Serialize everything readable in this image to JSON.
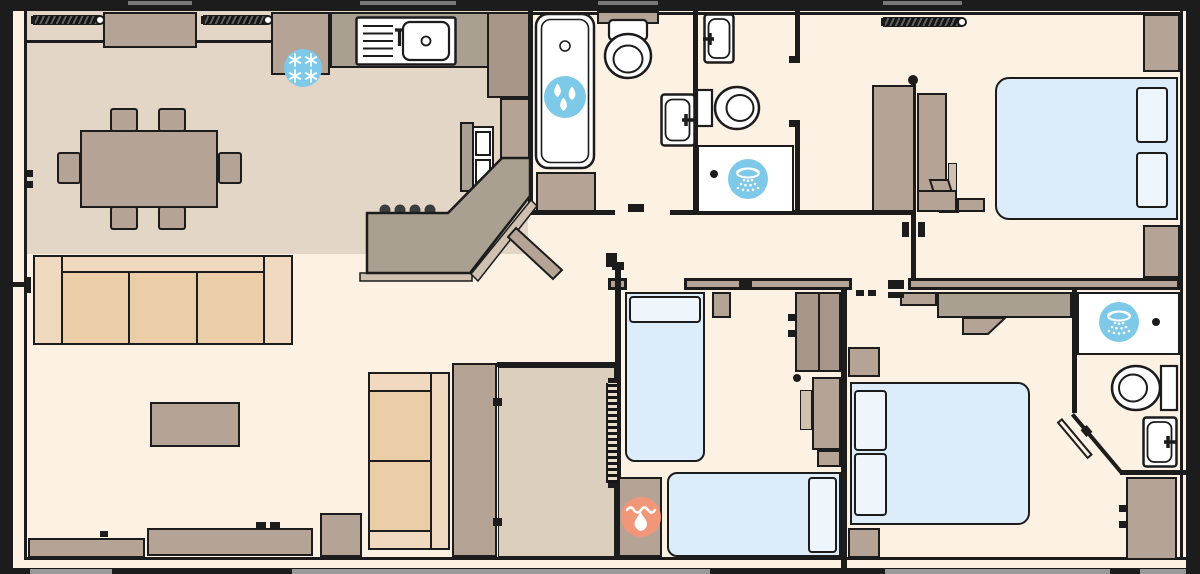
{
  "palette": {
    "wall": "#1c1c1c",
    "cream": "#fcf1e3",
    "beige": "#e4d6c6",
    "storage": "#dccfbe",
    "taupe": "#b5a396",
    "taupe-dark": "#a79689",
    "counter": "#a9a092",
    "trim": "#cfc0b0",
    "sofa-back": "#f0d9bf",
    "sofa-seat": "#ebcda7",
    "bed": "#dcecf8",
    "pillow": "#eef6fc",
    "blue": "#7fc9e8",
    "orange": "#f2967a",
    "chassis": "#9a9a9a",
    "white": "#ffffff"
  },
  "plan": {
    "type": "holiday-lodge-floor-plan",
    "icons": [
      {
        "name": "freezer-icon",
        "glyph": "snowflakes",
        "color_key": "blue",
        "location": "kitchen fridge-freezer"
      },
      {
        "name": "bath-icon",
        "glyph": "water-drops",
        "color_key": "blue",
        "location": "family bathroom bath"
      },
      {
        "name": "shower-icon-family",
        "glyph": "shower-spray",
        "color_key": "blue",
        "location": "shower room"
      },
      {
        "name": "shower-icon-ensuite",
        "glyph": "shower-spray",
        "color_key": "blue",
        "location": "second en-suite"
      },
      {
        "name": "heating-icon",
        "glyph": "flame-and-water",
        "color_key": "orange",
        "location": "boiler cupboard"
      }
    ],
    "rooms": [
      "dining-area",
      "kitchen",
      "family-bathroom",
      "shower-room",
      "master-bedroom",
      "living-room",
      "hallway",
      "storage-cupboard",
      "twin-bedroom",
      "double-bedroom",
      "second-ensuite"
    ],
    "fixture_counts": {
      "beds": 4,
      "sofas": 2,
      "dining_chairs": 6,
      "toilets": 3,
      "basins": 4,
      "showers": 2,
      "baths": 1,
      "window_blinds": 3,
      "radiators": 1
    }
  }
}
